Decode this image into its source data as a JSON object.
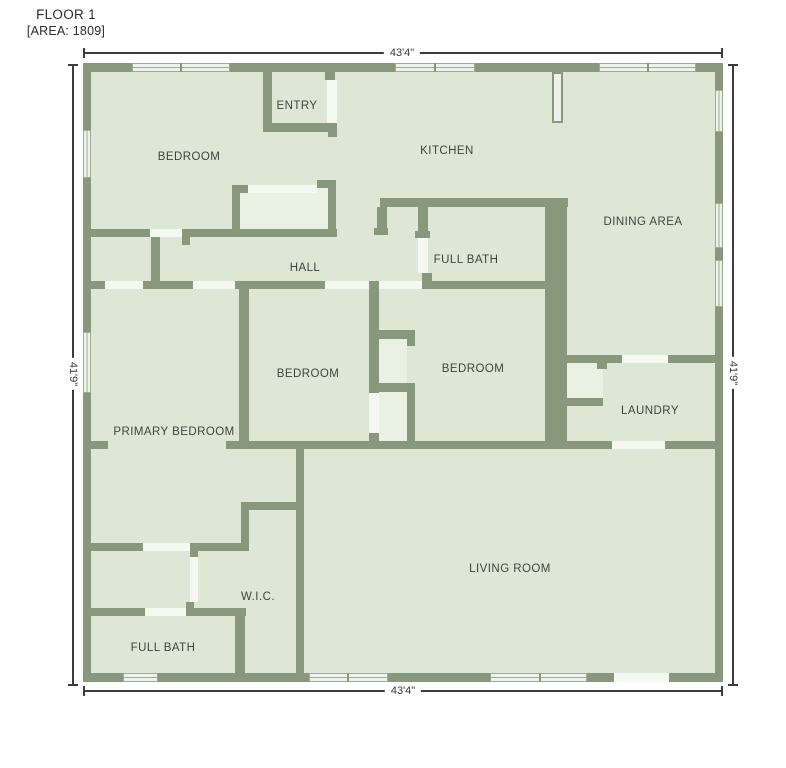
{
  "title": {
    "line1": "FLOOR 1",
    "line2": "[AREA: 1809]"
  },
  "colors": {
    "wall": "#87987d",
    "room_fill": "#dce8d5",
    "closet_fill": "#e9f1e3",
    "opening": "#f4f8f0",
    "window_glass": "#edf3ea",
    "window_frame": "#9eab95",
    "dimension": "#3c3c3c",
    "label_text": "#3a463c",
    "background": "#ffffff"
  },
  "geometry": {
    "interior": {
      "x": 91,
      "y": 72,
      "w": 624,
      "h": 601
    },
    "light_areas": [
      {
        "x": 240,
        "y": 188,
        "w": 88,
        "h": 44
      },
      {
        "x": 379,
        "y": 339,
        "w": 28,
        "h": 44
      },
      {
        "x": 379,
        "y": 392,
        "w": 28,
        "h": 49
      },
      {
        "x": 567,
        "y": 363,
        "w": 36,
        "h": 35
      }
    ],
    "walls": [
      {
        "x": 83,
        "y": 63,
        "w": 640,
        "h": 9
      },
      {
        "x": 83,
        "y": 673,
        "w": 640,
        "h": 9
      },
      {
        "x": 83,
        "y": 63,
        "w": 8,
        "h": 619
      },
      {
        "x": 715,
        "y": 63,
        "w": 8,
        "h": 619
      },
      {
        "x": 263,
        "y": 72,
        "w": 9,
        "h": 51
      },
      {
        "x": 263,
        "y": 123,
        "w": 74,
        "h": 9
      },
      {
        "x": 328,
        "y": 123,
        "w": 9,
        "h": 14
      },
      {
        "x": 325,
        "y": 72,
        "w": 10,
        "h": 8
      },
      {
        "x": 232,
        "y": 185,
        "w": 8,
        "h": 47
      },
      {
        "x": 240,
        "y": 185,
        "w": 8,
        "h": 8
      },
      {
        "x": 328,
        "y": 180,
        "w": 8,
        "h": 52
      },
      {
        "x": 317,
        "y": 180,
        "w": 11,
        "h": 8
      },
      {
        "x": 83,
        "y": 229,
        "w": 67,
        "h": 8
      },
      {
        "x": 182,
        "y": 229,
        "w": 8,
        "h": 16
      },
      {
        "x": 190,
        "y": 229,
        "w": 147,
        "h": 8
      },
      {
        "x": 151,
        "y": 237,
        "w": 9,
        "h": 46
      },
      {
        "x": 91,
        "y": 281,
        "w": 14,
        "h": 8
      },
      {
        "x": 143,
        "y": 281,
        "w": 50,
        "h": 8
      },
      {
        "x": 235,
        "y": 281,
        "w": 90,
        "h": 8
      },
      {
        "x": 239,
        "y": 281,
        "w": 10,
        "h": 160
      },
      {
        "x": 369,
        "y": 281,
        "w": 10,
        "h": 112
      },
      {
        "x": 379,
        "y": 330,
        "w": 36,
        "h": 9
      },
      {
        "x": 407,
        "y": 339,
        "w": 8,
        "h": 7
      },
      {
        "x": 372,
        "y": 383,
        "w": 43,
        "h": 9
      },
      {
        "x": 407,
        "y": 392,
        "w": 8,
        "h": 49
      },
      {
        "x": 369,
        "y": 433,
        "w": 10,
        "h": 8
      },
      {
        "x": 380,
        "y": 198,
        "w": 188,
        "h": 9
      },
      {
        "x": 377,
        "y": 207,
        "w": 10,
        "h": 28
      },
      {
        "x": 374,
        "y": 228,
        "w": 14,
        "h": 7
      },
      {
        "x": 418,
        "y": 207,
        "w": 10,
        "h": 31
      },
      {
        "x": 415,
        "y": 231,
        "w": 15,
        "h": 7
      },
      {
        "x": 422,
        "y": 273,
        "w": 10,
        "h": 8
      },
      {
        "x": 422,
        "y": 281,
        "w": 123,
        "h": 8
      },
      {
        "x": 545,
        "y": 198,
        "w": 22,
        "h": 245
      },
      {
        "x": 567,
        "y": 355,
        "w": 55,
        "h": 8
      },
      {
        "x": 597,
        "y": 363,
        "w": 10,
        "h": 6
      },
      {
        "x": 668,
        "y": 355,
        "w": 47,
        "h": 8
      },
      {
        "x": 567,
        "y": 398,
        "w": 36,
        "h": 8
      },
      {
        "x": 83,
        "y": 441,
        "w": 25,
        "h": 8
      },
      {
        "x": 226,
        "y": 441,
        "w": 386,
        "h": 8
      },
      {
        "x": 665,
        "y": 441,
        "w": 50,
        "h": 8
      },
      {
        "x": 296,
        "y": 441,
        "w": 8,
        "h": 241
      },
      {
        "x": 241,
        "y": 502,
        "w": 60,
        "h": 8
      },
      {
        "x": 241,
        "y": 510,
        "w": 8,
        "h": 41
      },
      {
        "x": 83,
        "y": 543,
        "w": 60,
        "h": 8
      },
      {
        "x": 190,
        "y": 543,
        "w": 58,
        "h": 8
      },
      {
        "x": 190,
        "y": 551,
        "w": 8,
        "h": 6
      },
      {
        "x": 83,
        "y": 608,
        "w": 62,
        "h": 8
      },
      {
        "x": 186,
        "y": 608,
        "w": 60,
        "h": 8
      },
      {
        "x": 186,
        "y": 602,
        "w": 8,
        "h": 6
      },
      {
        "x": 235,
        "y": 616,
        "w": 10,
        "h": 57
      }
    ],
    "openings": [
      {
        "x": 327,
        "y": 80,
        "w": 10,
        "h": 43
      },
      {
        "x": 248,
        "y": 185,
        "w": 69,
        "h": 8
      },
      {
        "x": 150,
        "y": 229,
        "w": 32,
        "h": 8
      },
      {
        "x": 105,
        "y": 281,
        "w": 38,
        "h": 8
      },
      {
        "x": 193,
        "y": 281,
        "w": 42,
        "h": 8
      },
      {
        "x": 325,
        "y": 281,
        "w": 44,
        "h": 8
      },
      {
        "x": 379,
        "y": 281,
        "w": 43,
        "h": 8
      },
      {
        "x": 418,
        "y": 238,
        "w": 10,
        "h": 35
      },
      {
        "x": 369,
        "y": 393,
        "w": 10,
        "h": 40
      },
      {
        "x": 622,
        "y": 355,
        "w": 46,
        "h": 8
      },
      {
        "x": 612,
        "y": 441,
        "w": 53,
        "h": 8
      },
      {
        "x": 143,
        "y": 543,
        "w": 47,
        "h": 8
      },
      {
        "x": 190,
        "y": 557,
        "w": 8,
        "h": 45
      },
      {
        "x": 145,
        "y": 608,
        "w": 41,
        "h": 8
      },
      {
        "x": 614,
        "y": 673,
        "w": 55,
        "h": 9
      }
    ],
    "windows": [
      {
        "x": 132,
        "y": 63,
        "w": 98,
        "h": 9,
        "orient": "h",
        "dividers": [
          180
        ]
      },
      {
        "x": 395,
        "y": 63,
        "w": 80,
        "h": 9,
        "orient": "h",
        "dividers": [
          434
        ]
      },
      {
        "x": 599,
        "y": 63,
        "w": 97,
        "h": 9,
        "orient": "h",
        "dividers": [
          647
        ]
      },
      {
        "x": 123,
        "y": 673,
        "w": 35,
        "h": 9,
        "orient": "h",
        "dividers": []
      },
      {
        "x": 309,
        "y": 673,
        "w": 79,
        "h": 9,
        "orient": "h",
        "dividers": [
          347
        ]
      },
      {
        "x": 490,
        "y": 673,
        "w": 97,
        "h": 9,
        "orient": "h",
        "dividers": [
          539
        ]
      },
      {
        "x": 83,
        "y": 130,
        "w": 8,
        "h": 48,
        "orient": "v",
        "dividers": []
      },
      {
        "x": 83,
        "y": 332,
        "w": 8,
        "h": 61,
        "orient": "v",
        "dividers": []
      },
      {
        "x": 715,
        "y": 90,
        "w": 8,
        "h": 42,
        "orient": "v",
        "dividers": []
      },
      {
        "x": 715,
        "y": 203,
        "w": 8,
        "h": 45,
        "orient": "v",
        "dividers": []
      },
      {
        "x": 715,
        "y": 260,
        "w": 8,
        "h": 47,
        "orient": "v",
        "dividers": []
      }
    ],
    "fixtures": [
      {
        "x": 552,
        "y": 72,
        "w": 11,
        "h": 51,
        "name": "kitchen-fixture"
      }
    ]
  },
  "rooms": [
    {
      "id": "entry",
      "label": "ENTRY",
      "x": 297,
      "y": 106
    },
    {
      "id": "bedroom-1",
      "label": "BEDROOM",
      "x": 189,
      "y": 157
    },
    {
      "id": "kitchen",
      "label": "KITCHEN",
      "x": 447,
      "y": 151
    },
    {
      "id": "dining-area",
      "label": "DINING AREA",
      "x": 643,
      "y": 222
    },
    {
      "id": "full-bath-1",
      "label": "FULL BATH",
      "x": 466,
      "y": 260
    },
    {
      "id": "hall",
      "label": "HALL",
      "x": 305,
      "y": 268
    },
    {
      "id": "bedroom-2",
      "label": "BEDROOM",
      "x": 308,
      "y": 374
    },
    {
      "id": "bedroom-3",
      "label": "BEDROOM",
      "x": 473,
      "y": 369
    },
    {
      "id": "laundry",
      "label": "LAUNDRY",
      "x": 650,
      "y": 411
    },
    {
      "id": "primary-bedroom",
      "label": "PRIMARY BEDROOM",
      "x": 174,
      "y": 432
    },
    {
      "id": "living-room",
      "label": "LIVING ROOM",
      "x": 510,
      "y": 569
    },
    {
      "id": "wic",
      "label": "W.I.C.",
      "x": 258,
      "y": 597
    },
    {
      "id": "full-bath-2",
      "label": "FULL BATH",
      "x": 163,
      "y": 648
    }
  ],
  "dimensions": [
    {
      "id": "top",
      "label": "43'4\"",
      "orient": "h",
      "x1": 83,
      "x2": 722,
      "pos": 52,
      "label_at": 402
    },
    {
      "id": "bottom",
      "label": "43'4\"",
      "orient": "h",
      "x1": 83,
      "x2": 722,
      "pos": 690,
      "label_at": 403
    },
    {
      "id": "left",
      "label": "41'9\"",
      "orient": "v",
      "y1": 64,
      "y2": 685,
      "pos": 72,
      "label_at": 374
    },
    {
      "id": "right",
      "label": "41'9\"",
      "orient": "v",
      "y1": 64,
      "y2": 685,
      "pos": 732,
      "label_at": 373
    }
  ]
}
